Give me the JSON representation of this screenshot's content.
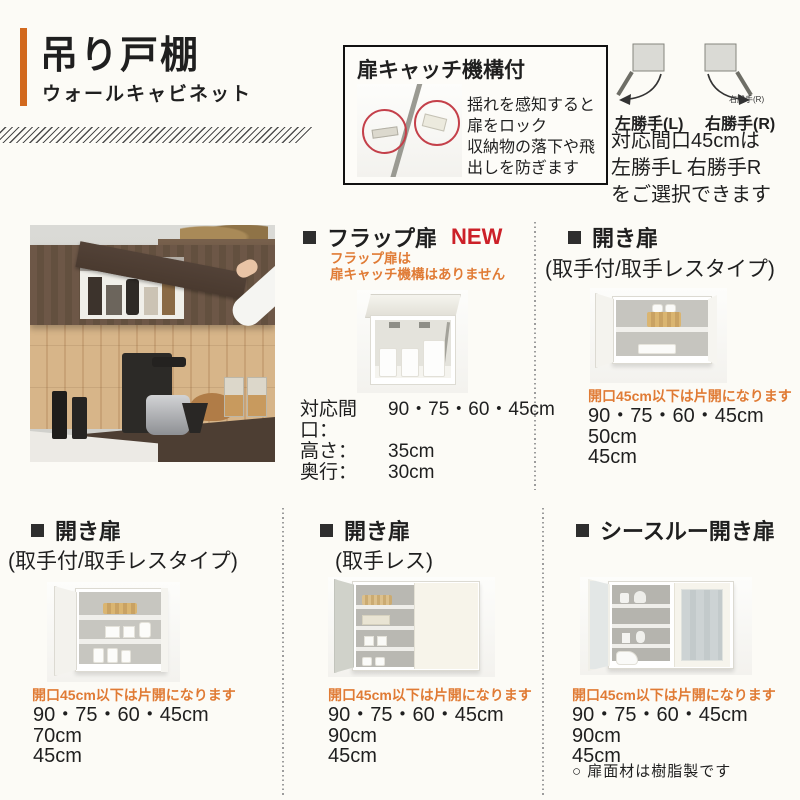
{
  "header": {
    "title": "吊り戸棚",
    "subtitle": "ウォールキャビネット"
  },
  "catch_box": {
    "title": "扉キャッチ機構付",
    "desc_line1": "揺れを感知すると",
    "desc_line2": "扉をロック",
    "desc_line3": "収納物の落下や飛",
    "desc_line4": "出しを防ぎます"
  },
  "hinge": {
    "left_label": "左勝手(L)",
    "right_label": "右勝手(R)",
    "right_small_label": "右勝手(R)",
    "note_line1": "対応間口45cmは",
    "note_line2": "左勝手L 右勝手R",
    "note_line3": "をご選択できます"
  },
  "flap_section": {
    "title": "フラップ扉",
    "badge": "NEW",
    "note_line1": "フラップ扉は",
    "note_line2": "扉キャッチ機構はありません",
    "spec_rows": [
      {
        "label": "対応間口：",
        "value": "90・75・60・45cm"
      },
      {
        "label": "高さ：",
        "value": "35cm"
      },
      {
        "label": "奥行：",
        "value": "30cm"
      }
    ]
  },
  "open_top_section": {
    "title": "開き扉",
    "subtitle": "(取手付/取手レスタイプ)",
    "note": "開口45cm以下は片開になります",
    "specs": [
      "90・75・60・45cm",
      "50cm",
      "45cm"
    ]
  },
  "open_left_section": {
    "title": "開き扉",
    "subtitle": "(取手付/取手レスタイプ)",
    "note": "開口45cm以下は片開になります",
    "specs": [
      "90・75・60・45cm",
      "70cm",
      "45cm"
    ]
  },
  "open_center_section": {
    "title": "開き扉",
    "subtitle": "(取手レス)",
    "note": "開口45cm以下は片開になります",
    "specs": [
      "90・75・60・45cm",
      "90cm",
      "45cm"
    ]
  },
  "see_through_section": {
    "title": "シースルー開き扉",
    "note": "開口45cm以下は片開になります",
    "specs": [
      "90・75・60・45cm",
      "90cm",
      "45cm"
    ],
    "material_note": "○ 扉面材は樹脂製です"
  },
  "colors": {
    "accent_bar": "#d2691e",
    "new_badge": "#cc2028",
    "note_orange": "#e07b35"
  }
}
